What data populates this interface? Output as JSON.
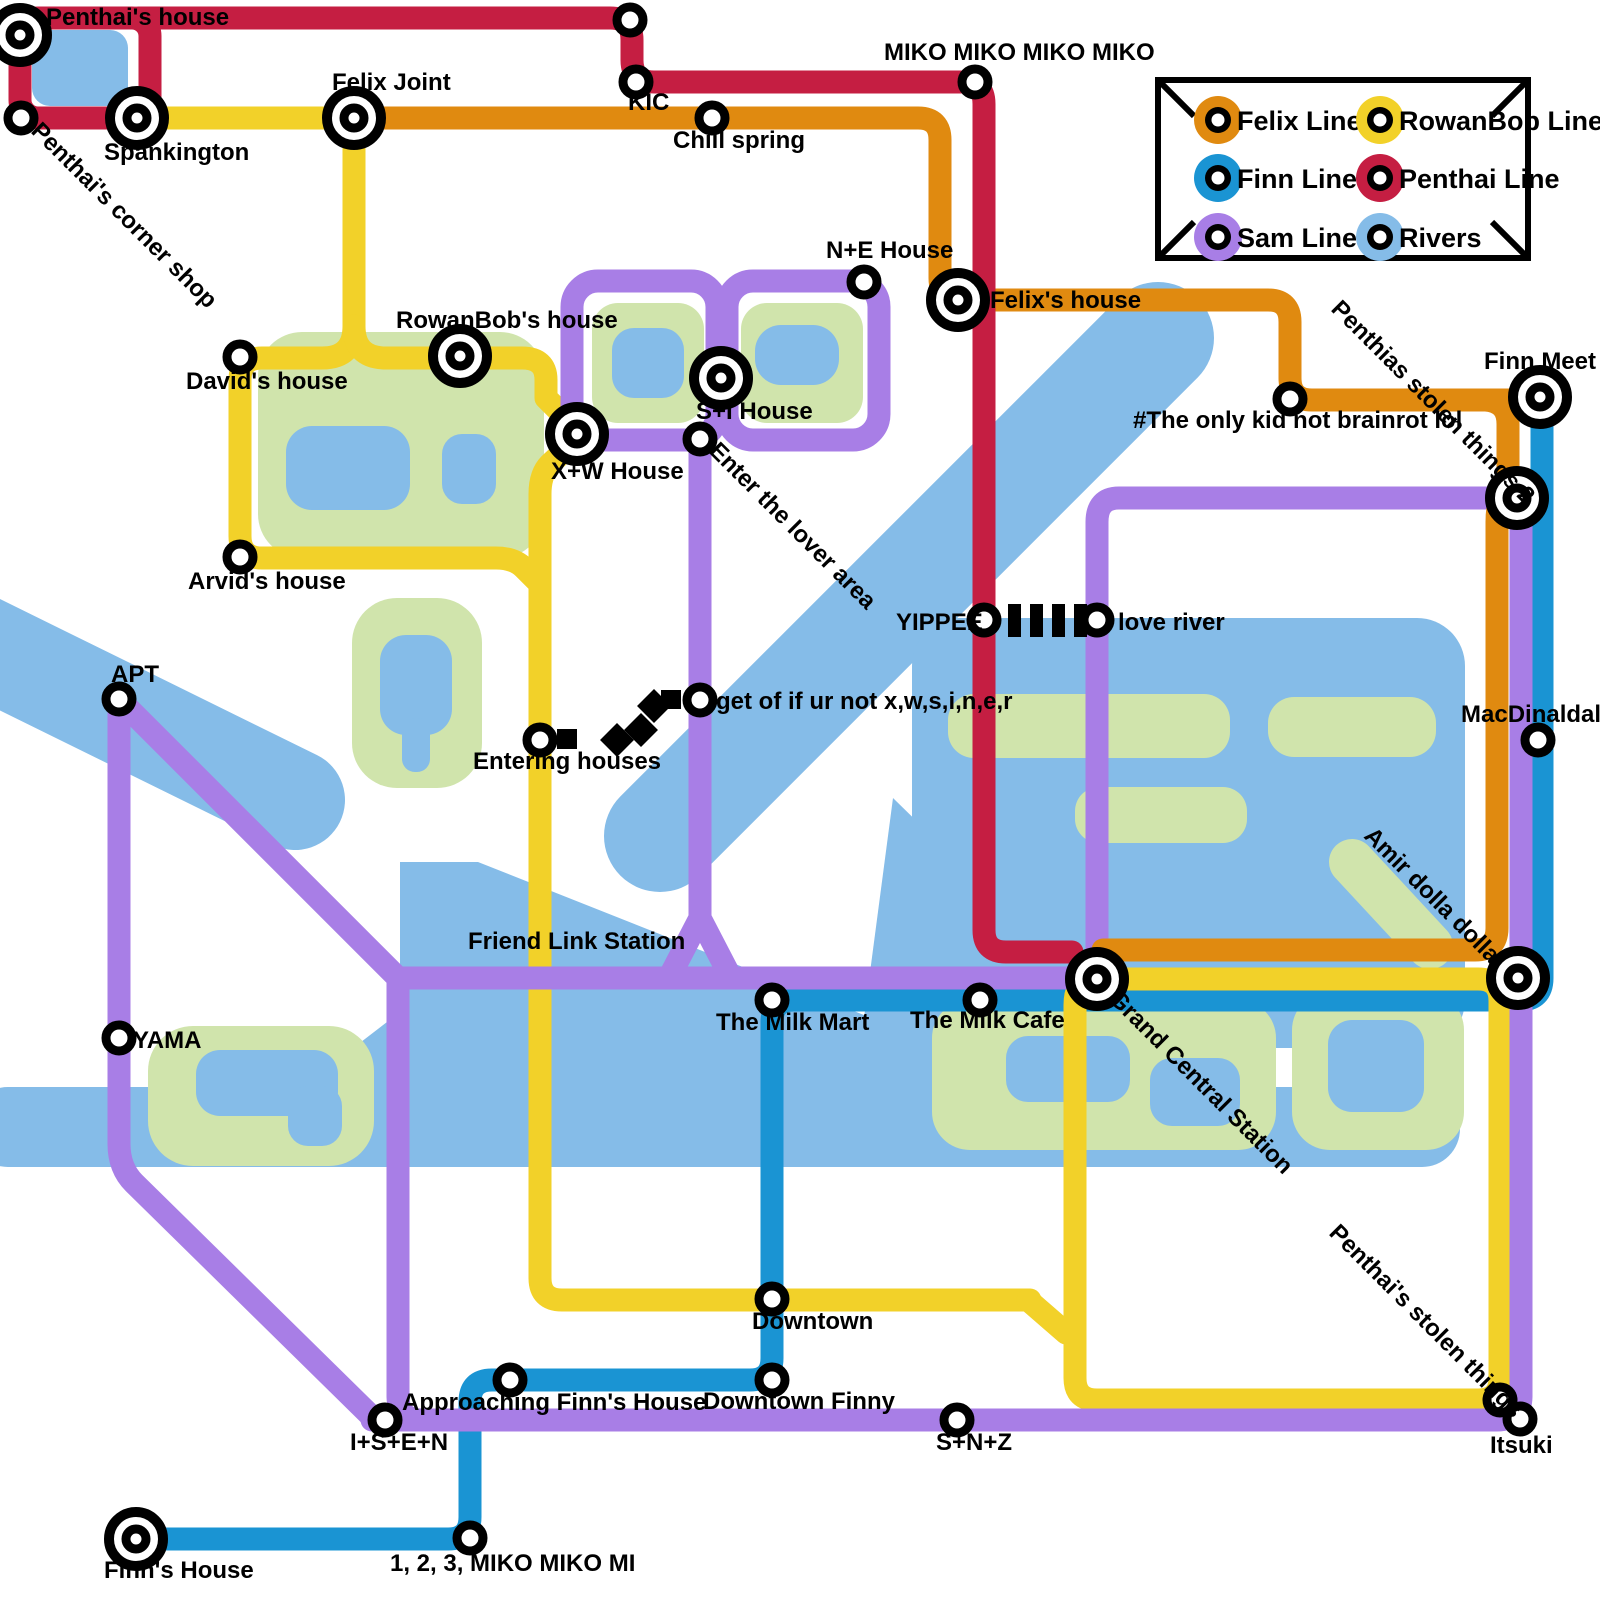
{
  "colors": {
    "felix": "#E08A10",
    "rowanbob": "#F2D129",
    "finn": "#1A94D3",
    "penthai": "#C51E42",
    "sam": "#A87EE6",
    "river": "#85BCE8",
    "park": "#D0E4AC",
    "label": "#000000",
    "background": "#FFFFFF"
  },
  "legend": {
    "items": [
      {
        "label": "Felix Line"
      },
      {
        "label": "RowanBob Line"
      },
      {
        "label": "Finn Line"
      },
      {
        "label": "Penthai Line"
      },
      {
        "label": "Sam Line"
      },
      {
        "label": "Rivers"
      }
    ]
  },
  "stations": {
    "penthais_house": "Penthai's house",
    "spankington": "Spankington",
    "corner_shop": "Penthai's corner shop",
    "felix_joint": "Felix Joint",
    "kic": "KIC",
    "miko4": "MIKO MIKO MIKO MIKO",
    "chill_spring": "Chill spring",
    "ne_house": "N+E House",
    "felixs_house": "Felix's house",
    "rowanbobs_house": "RowanBob's house",
    "davids_house": "David's house",
    "si_house": "S+I House",
    "xw_house": "X+W House",
    "arvids_house": "Arvid's house",
    "enter_lover": "Enter the lover area",
    "only_kid": "#The only kid not brainrot lol",
    "finn_meet": "Finn Meet",
    "stolen2": "Penthias stolen things 2",
    "yippee": "YIPPEE",
    "love_river": "love river",
    "apt": "APT",
    "get_of": "get of if ur not x,w,s,i,n,e,r",
    "entering_houses": "Entering houses",
    "macdinaldal": "MacDinaldal",
    "yama": "YAMA",
    "friend_link": "Friend Link Station",
    "milk_mart": "The Milk Mart",
    "milk_cafe": "The Milk Cafe",
    "gcs": "Grand Central Station",
    "amir": "Amir dolla dolla",
    "downtown": "Downtown",
    "approaching": "Approaching Finn's House",
    "downtown_finny": "Downtown Finny",
    "snz": "S+N+Z",
    "isen": "I+S+E+N",
    "stolen1": "Penthai's stolen things",
    "itsuki": "Itsuki",
    "finns_house": "Finn's House",
    "miko123": "1, 2, 3, MIKO MIKO MI"
  }
}
